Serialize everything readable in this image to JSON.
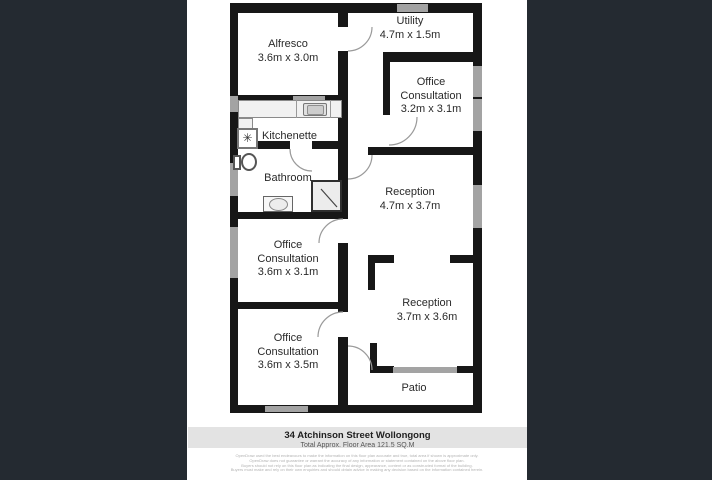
{
  "colors": {
    "background": "#242a31",
    "canvas": "#ffffff",
    "wall": "#171717",
    "window": "#a3a3a3",
    "arc": "#9a9a9a",
    "footer_bar": "#e3e3e3"
  },
  "plan": {
    "rooms": {
      "alfresco": {
        "name": "Alfresco",
        "dims": "3.6m x 3.0m"
      },
      "utility": {
        "name": "Utility",
        "dims": "4.7m x 1.5m"
      },
      "office_consultation_1": {
        "line1": "Office",
        "line2": "Consultation",
        "dims": "3.2m x 3.1m"
      },
      "kitchenette": {
        "name": "Kitchenette"
      },
      "bathroom": {
        "name": "Bathroom"
      },
      "reception_1": {
        "name": "Reception",
        "dims": "4.7m x 3.7m"
      },
      "office_consultation_2": {
        "line1": "Office",
        "line2": "Consultation",
        "dims": "3.6m x 3.1m"
      },
      "reception_2": {
        "name": "Reception",
        "dims": "3.7m x 3.6m"
      },
      "office_consultation_3": {
        "line1": "Office",
        "line2": "Consultation",
        "dims": "3.6m x 3.5m"
      },
      "patio": {
        "name": "Patio"
      }
    },
    "symbols": {
      "fan": "✳"
    }
  },
  "footer": {
    "address": "34 Atchinson Street Wollongong",
    "area": "Total Approx. Floor Area 121.5 SQ.M",
    "disclaimer": [
      "OpenDraw used the best endeavours to make the information on this floor plan accurate and true, total area if shown is approximate only.",
      "OpenDraw does not guarantee or warrant the accuracy of any information or statement contained on the above floor plan.",
      "Buyers should not rely on this floor plan as indicating the final design, appearance, content or as constructed format of the building.",
      "Buyers must make and rely on their own enquiries and should obtain advice in making any decision based on the information contained herein."
    ]
  }
}
